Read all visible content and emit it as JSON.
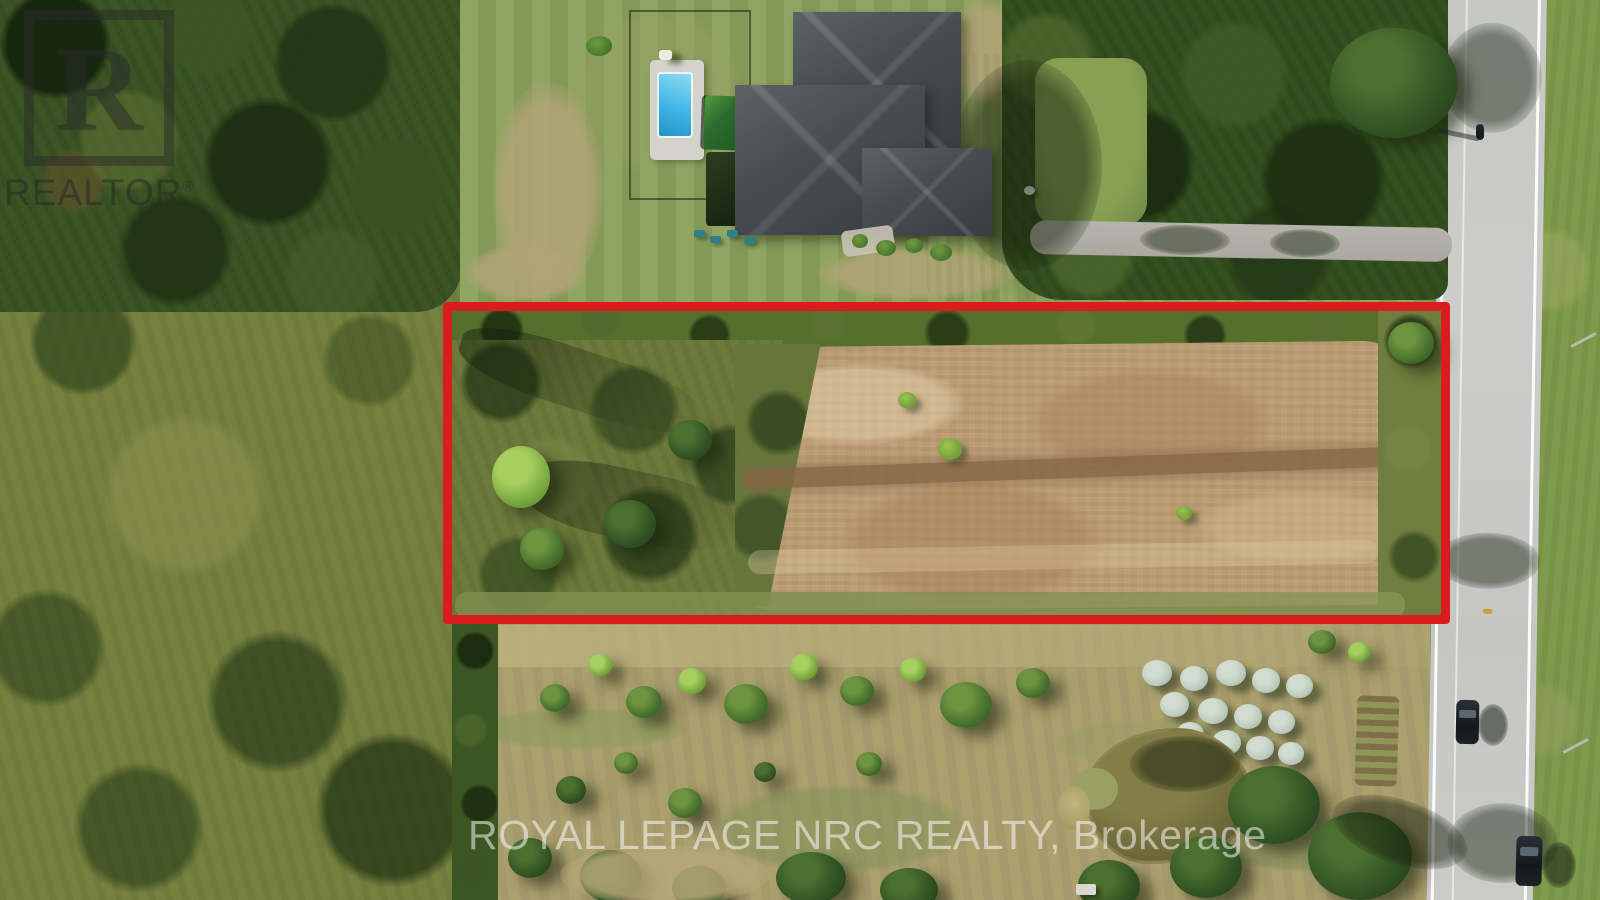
{
  "watermarks": {
    "realtor_logo": {
      "letter": "R",
      "label": "REALTOR",
      "reg": "®"
    },
    "brokerage": {
      "text": "ROYAL LEPAGE NRC REALTY, Brokerage"
    }
  },
  "annotation": {
    "parcel_outline": {
      "shape": "rectangle",
      "color": "#d91c1c"
    }
  },
  "colors": {
    "outline_red": "#d91c1c",
    "lawn_green": "#8ba05b",
    "scrub_olive": "#76813f",
    "field_tan": "#aca06f",
    "dirt_tan": "#bb9c72",
    "road_gray": "#c9c9c6",
    "driveway_gray": "#b0aea6",
    "roof_gray": "#42474c",
    "pool_blue": "#3fb6e6",
    "deck_white": "#d3d3cb",
    "pond_olive": "#716d3a",
    "bush_silver": "#b9cabc",
    "watermark_white": "rgba(255,255,255,0.52)",
    "watermark_dark": "rgba(42,42,42,0.55)"
  }
}
